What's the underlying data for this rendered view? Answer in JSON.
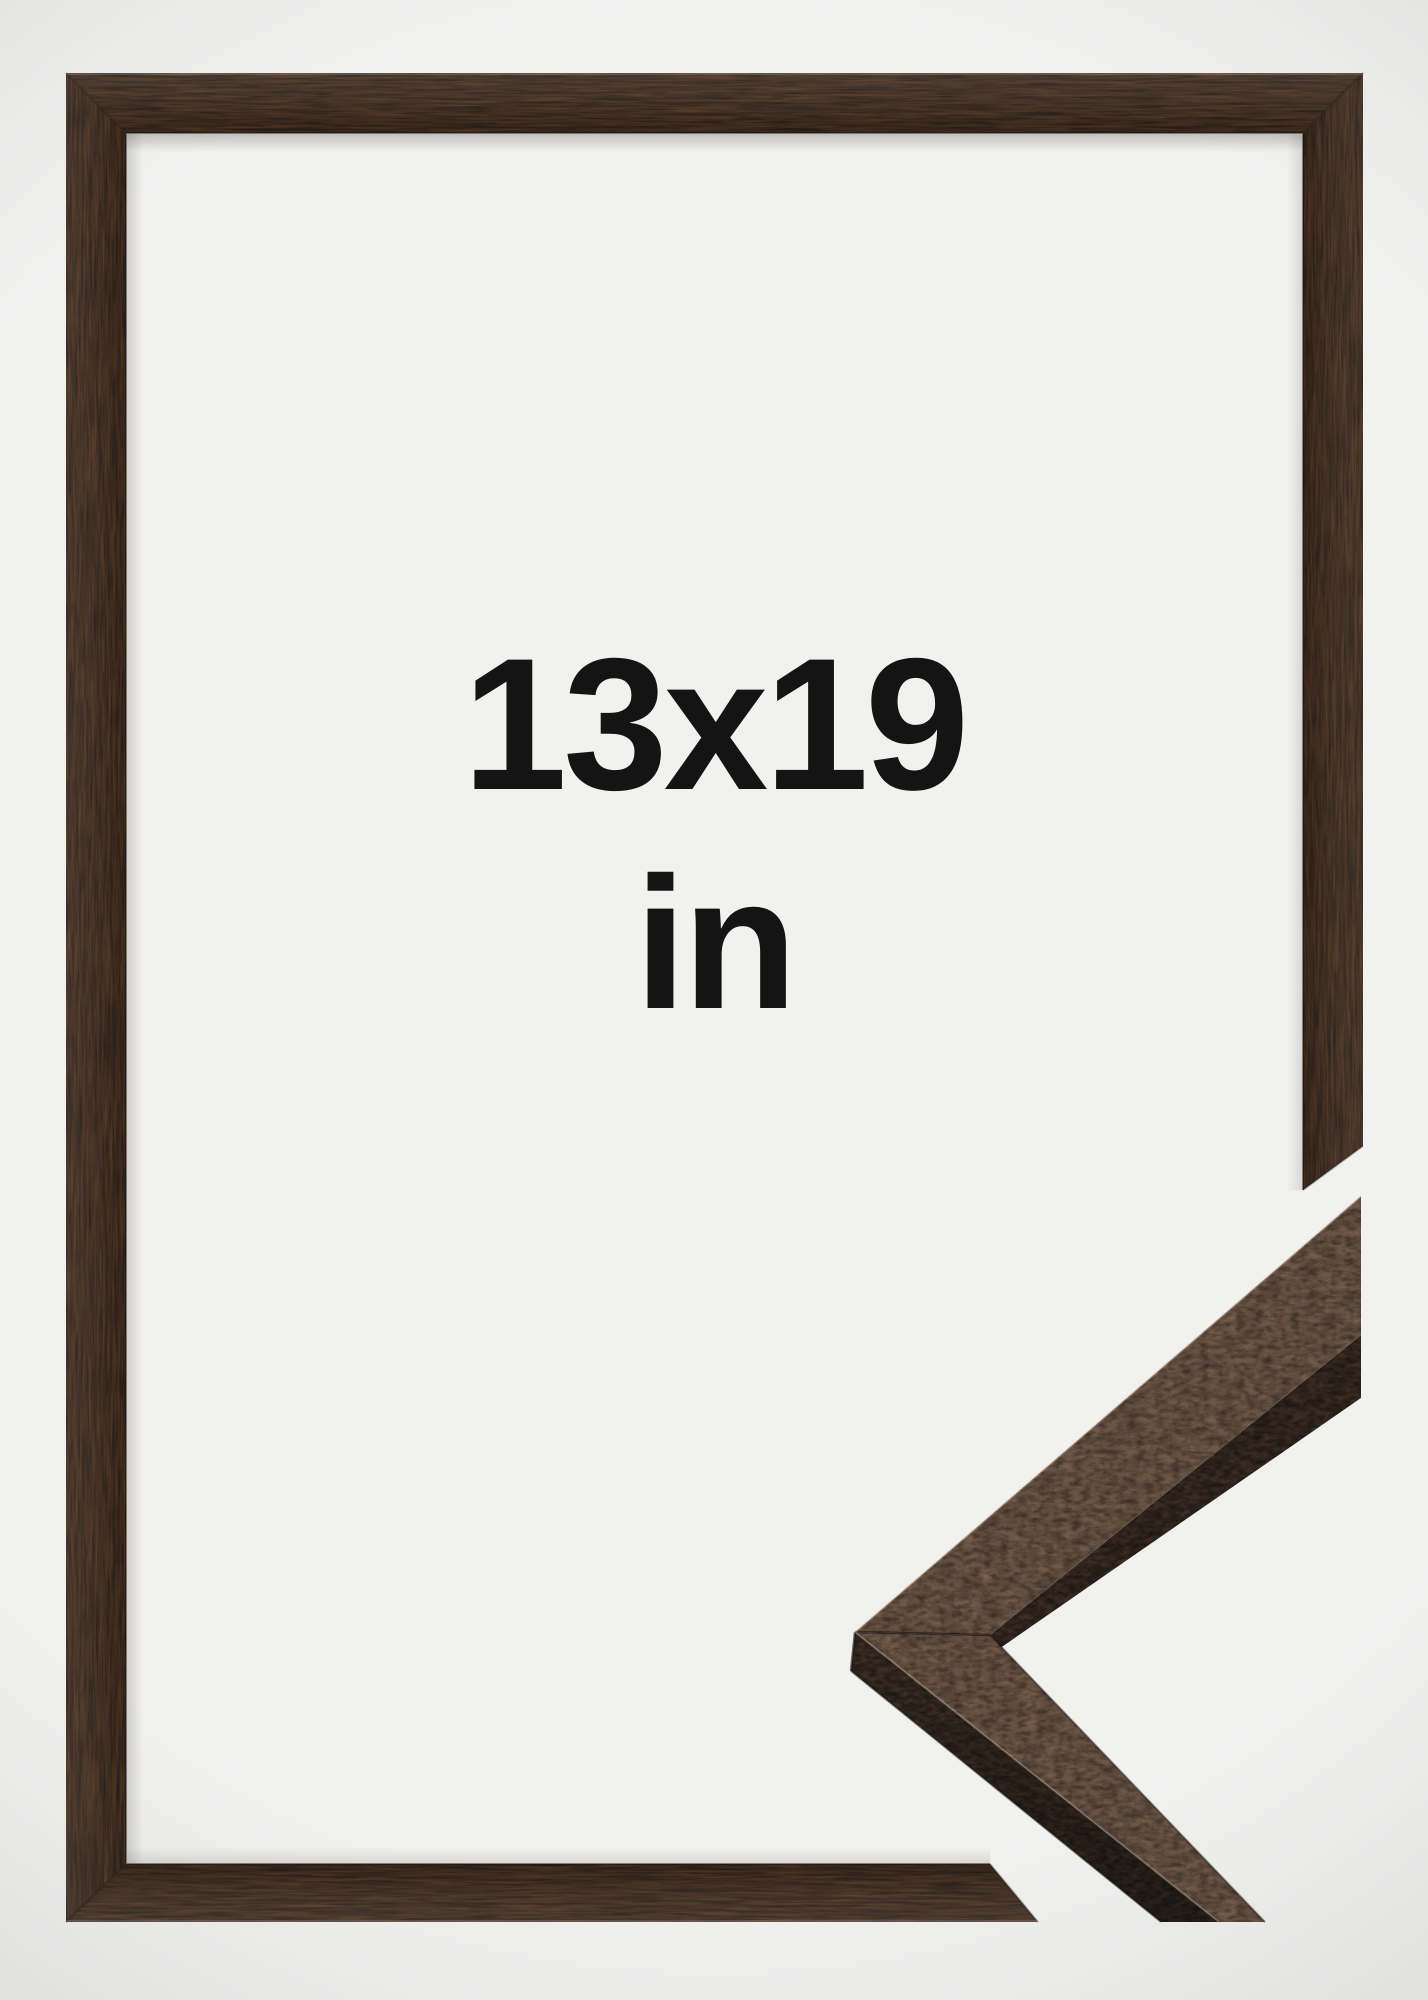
{
  "size_label": {
    "dimensions": "13x19",
    "unit": "in"
  },
  "colors": {
    "background": "#f1f1f0",
    "frame_wood_base": "#31231a",
    "detail_face_base": "#57463a",
    "detail_side_base": "#352921",
    "detail_lip_base": "#2d221b",
    "label_text": "#141414"
  }
}
